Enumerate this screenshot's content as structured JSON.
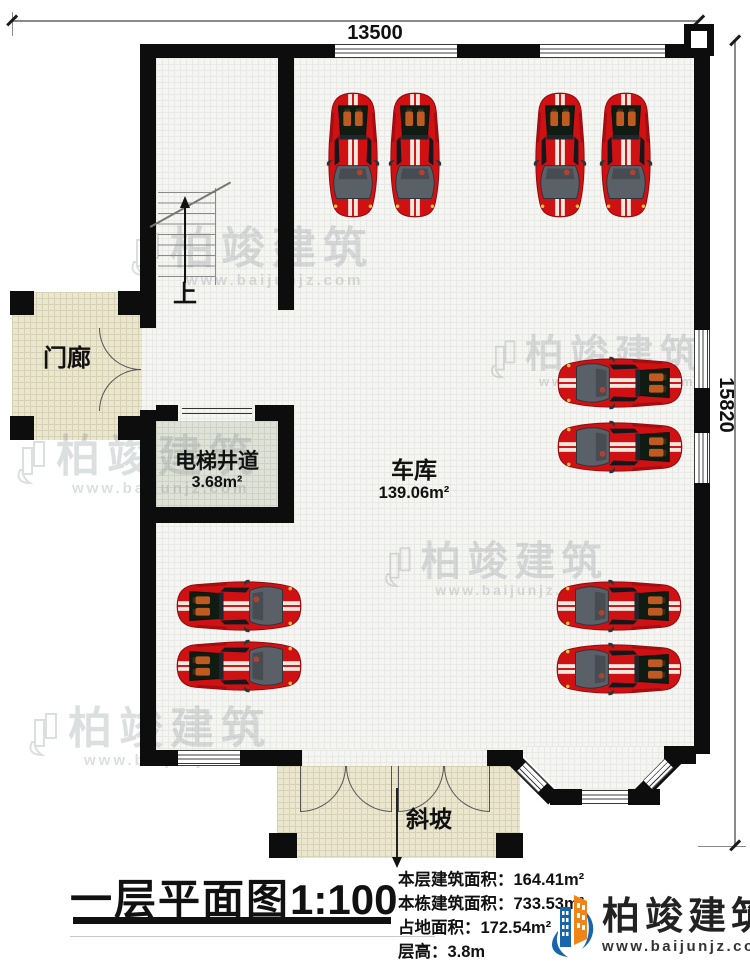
{
  "plan": {
    "dimension_top": "13500",
    "dimension_right": "15820",
    "rooms": {
      "porch": {
        "label": "门廊"
      },
      "elevator": {
        "label": "电梯井道",
        "area": "3.68m²"
      },
      "garage": {
        "label": "车库",
        "area": "139.06m²"
      },
      "slope": {
        "label": "斜坡"
      },
      "stair_up": {
        "label": "上"
      }
    }
  },
  "footer": {
    "title": "一层平面图",
    "scale": "1:100",
    "info": [
      {
        "label": "本层建筑面积：",
        "value": "164.41m²"
      },
      {
        "label": "本栋建筑面积：",
        "value": "733.53m²"
      },
      {
        "label": "占地面积：",
        "value": "172.54m²"
      },
      {
        "label": "层高：",
        "value": "3.8m"
      }
    ]
  },
  "brand": {
    "name": "柏竣建筑",
    "site": "www.baijunjz.com"
  },
  "watermark": {
    "text": "柏竣建筑",
    "site": "www.baijunjz.com"
  },
  "colors": {
    "wall": "#0d0d0d",
    "car_red": "#cf1114",
    "brand_blue": "#1766ad",
    "brand_orange": "#f08419"
  }
}
